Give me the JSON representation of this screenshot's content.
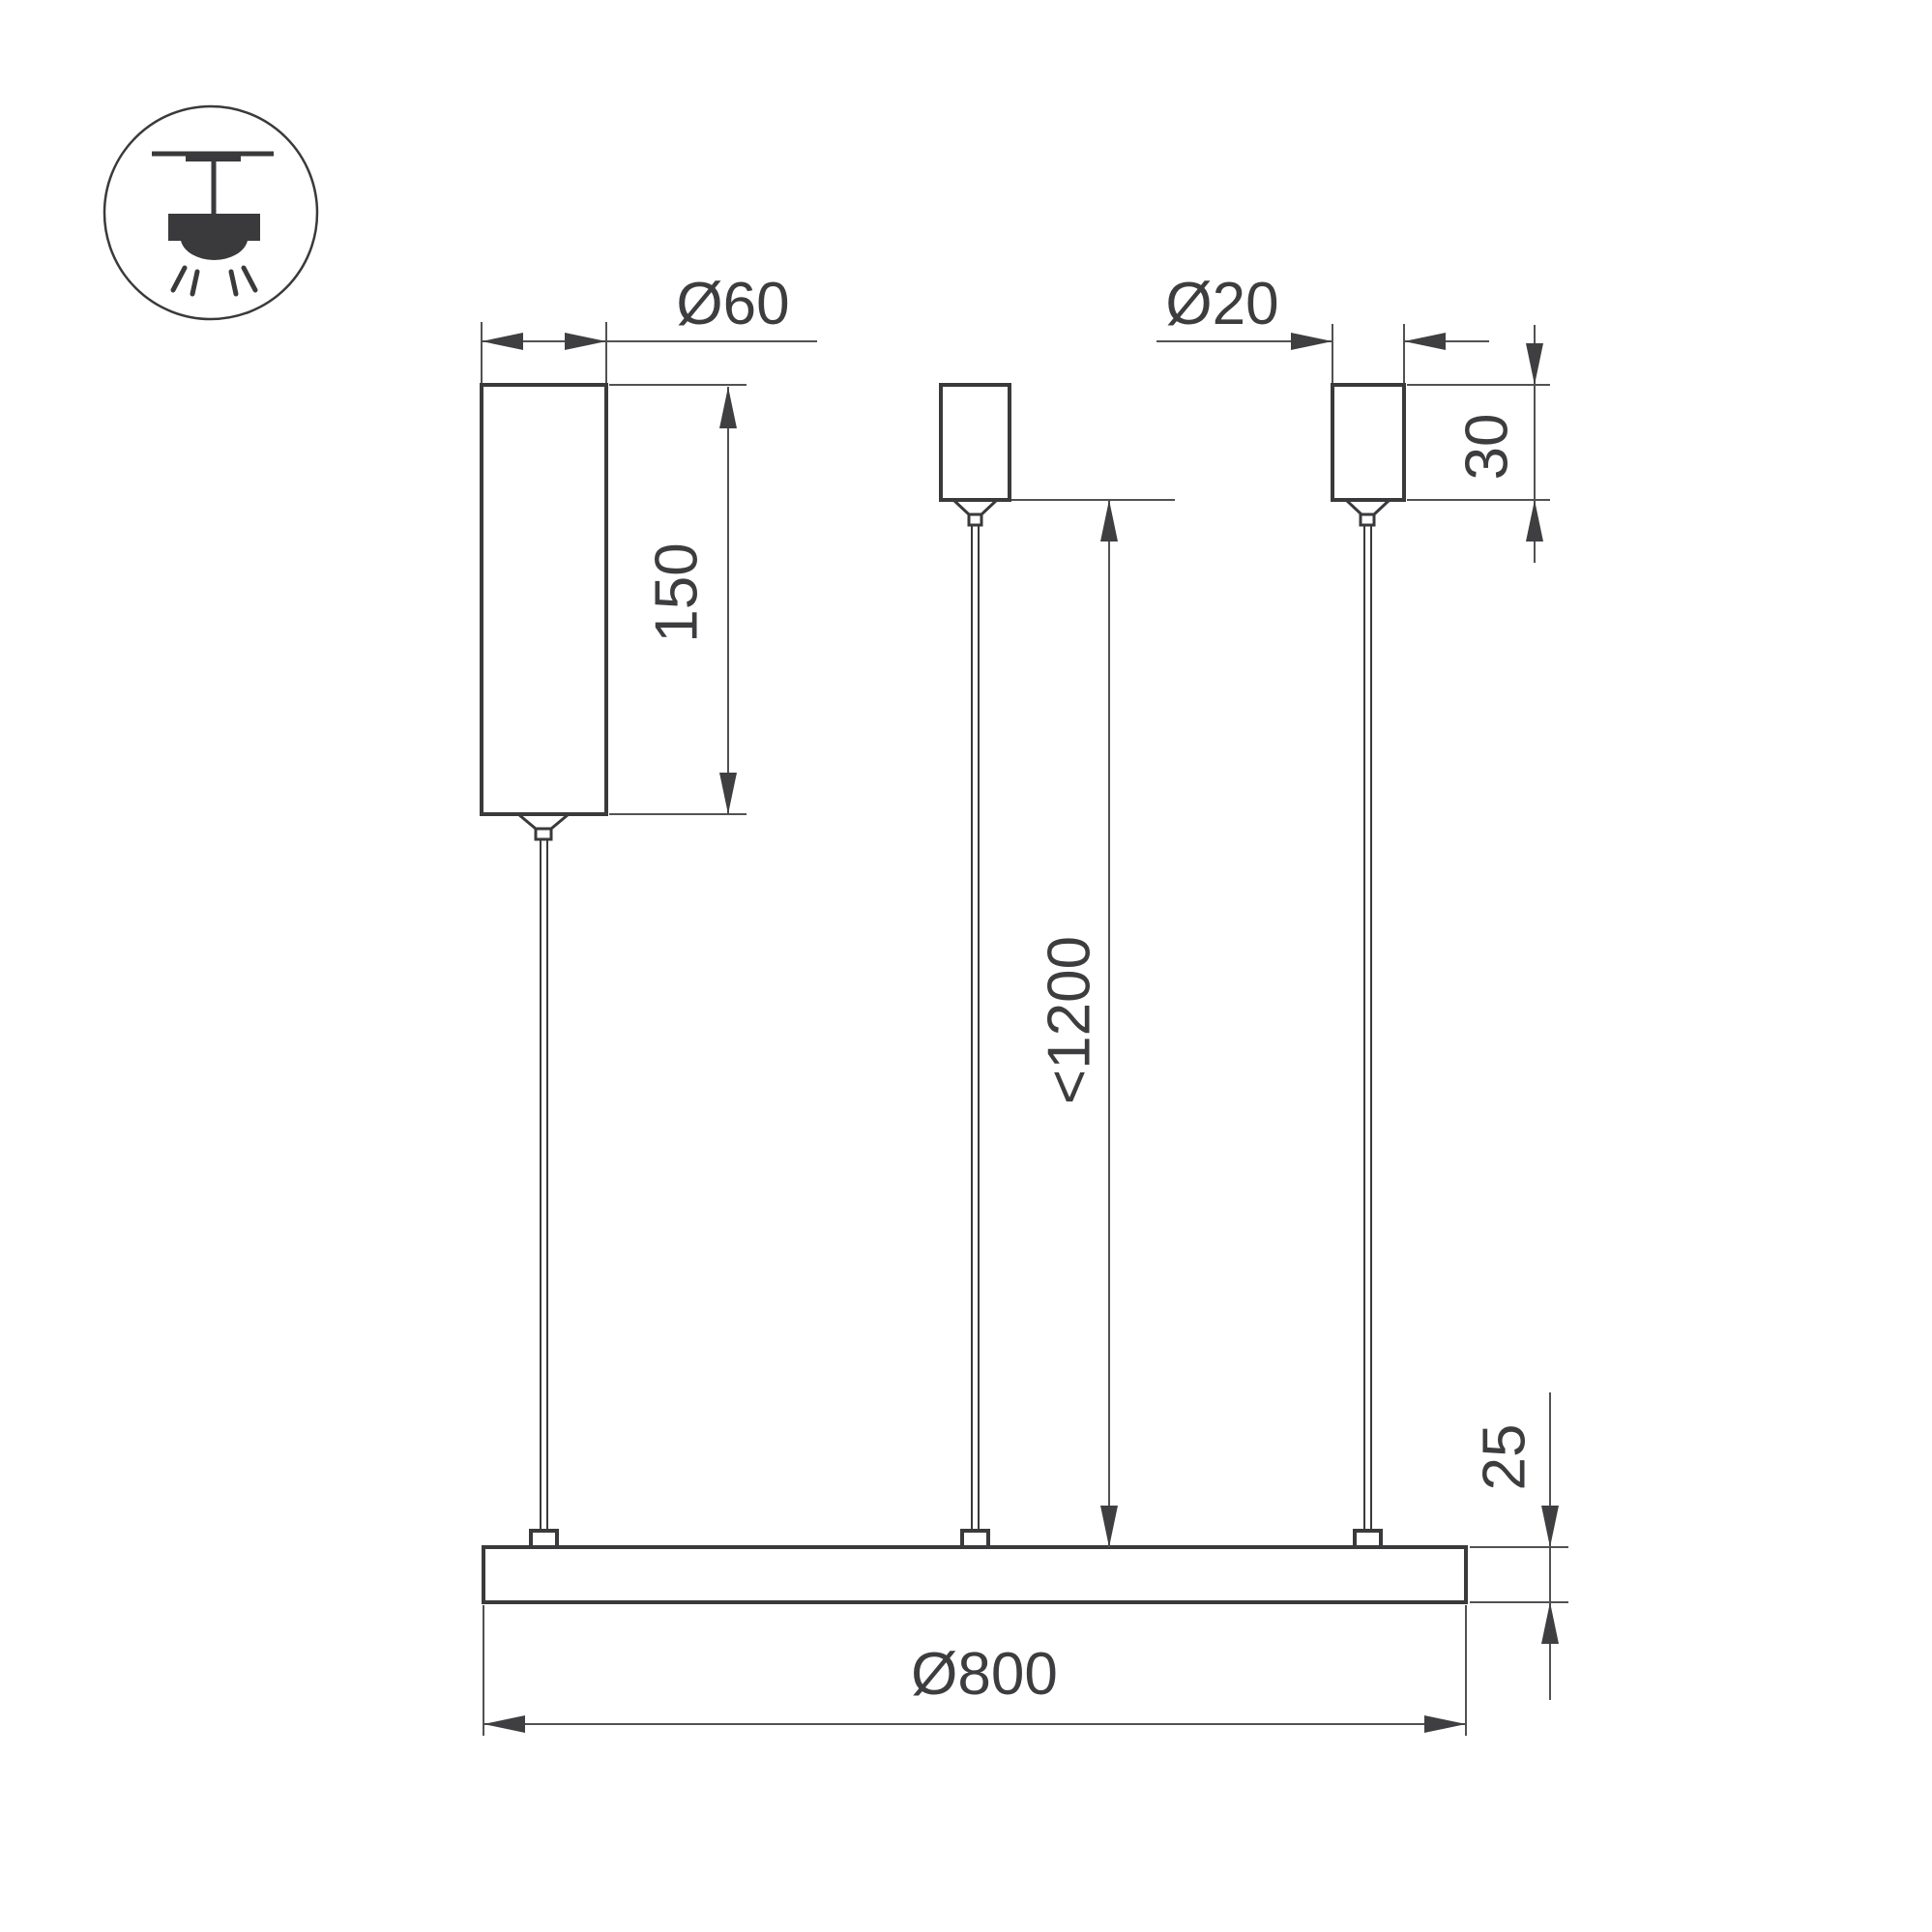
{
  "drawing": {
    "kind": "pendant-luminaire-dimension-drawing",
    "icon": {
      "name": "pendant-ceiling-light"
    },
    "colors": {
      "background": "#ffffff",
      "shape_line": "#3a3a3c",
      "dimension_line": "#525255",
      "text": "#3d3d40"
    },
    "dimensions": {
      "driver_diameter": "Ø60",
      "driver_length": "150",
      "canopy_diameter": "Ø20",
      "canopy_height": "30",
      "suspension_length": "<1200",
      "profile_height": "25",
      "ring_diameter": "Ø800"
    }
  }
}
